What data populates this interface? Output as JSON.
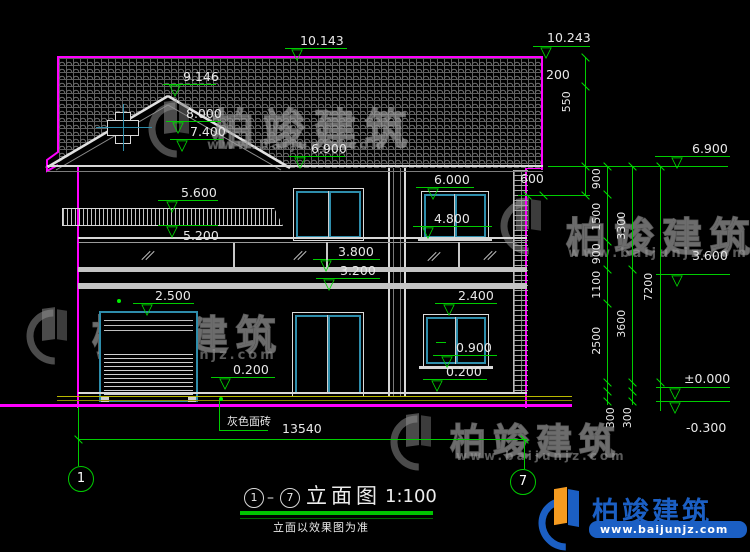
{
  "levels": {
    "roof_left": "10.143",
    "roof_right": "10.243",
    "gable_ridge": "9.146",
    "gable_mid": "8.000",
    "gable_low": "7.400",
    "eave_left": "6.900",
    "eave_right": "6.900",
    "win2_top": "6.000",
    "canopy_top": "5.600",
    "canopy_bottom": "5.200",
    "win2_sill": "4.800",
    "railing_top": "3.800",
    "floor2": "3.200",
    "garage_top": "2.500",
    "win1_top": "2.400",
    "win1_sill": "0.900",
    "plinth_left": "0.200",
    "plinth_right": "0.200",
    "right_mid": "3.600",
    "ground": "±0.000",
    "site": "-0.300"
  },
  "dimensions": {
    "parapet": "200",
    "fascia": "550",
    "overhang": "600",
    "seg_900a": "900",
    "seg_1500": "1500",
    "seg_900b": "900",
    "seg_1100": "1100",
    "seg_2500": "2500",
    "seg_3300": "3300",
    "seg_3600": "3600",
    "total_height": "7200",
    "seg_300a": "300",
    "seg_300b": "300",
    "total_width": "13540"
  },
  "annotations": {
    "material": "灰色面砖"
  },
  "axes": {
    "left": "1",
    "right": "7"
  },
  "title_block": {
    "axis_from": "1",
    "axis_to": "7",
    "separator": "–",
    "name": "立面图",
    "scale": "1:100",
    "note": "立面以效果图为准"
  },
  "watermark": {
    "brand": "柏竣建筑",
    "url": "www.baijunjz.com"
  },
  "logo": {
    "brand": "柏竣建筑",
    "url": "www.baijunjz.com"
  },
  "colors": {
    "outline_magenta": "#ff00ff",
    "dimension_green": "#00cc00",
    "window_teal": "#2e8dab",
    "plinth_yellow": "#b9b900",
    "logo_blue": "#1b5fc4",
    "logo_orange": "#f59b20"
  }
}
